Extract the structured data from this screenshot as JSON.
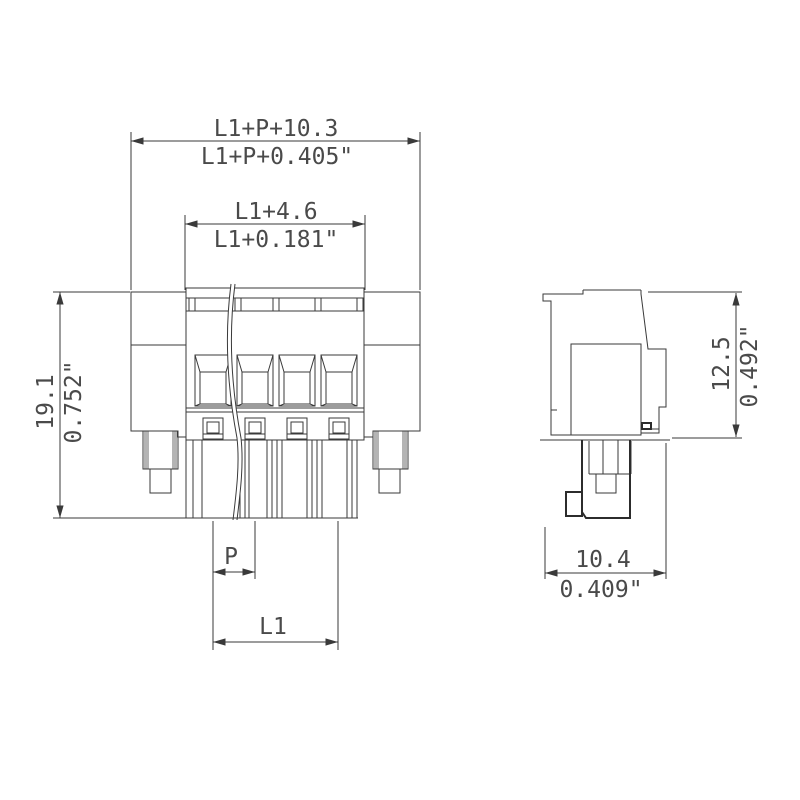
{
  "drawing": {
    "type": "technical-dimension-drawing",
    "subject": "pluggable terminal block connector, front and side views",
    "background": "#ffffff"
  },
  "dimensions": {
    "overall_width_mm": "L1+P+10.3",
    "overall_width_in": "L1+P+0.405\"",
    "inner_width_mm": "L1+4.6",
    "inner_width_in": "L1+0.181\"",
    "height_mm": "19.1",
    "height_in": "0.752\"",
    "side_height_mm": "12.5",
    "side_height_in": "0.492\"",
    "depth_mm": "10.4",
    "depth_in": "0.409\"",
    "pitch_label": "P",
    "length_label": "L1"
  },
  "colors": {
    "line": "#3a3a3a",
    "text": "#4a4a4a",
    "shading_gray": "#b4b4b4",
    "pin_gray": "#9e9e9e",
    "background": "#ffffff"
  }
}
